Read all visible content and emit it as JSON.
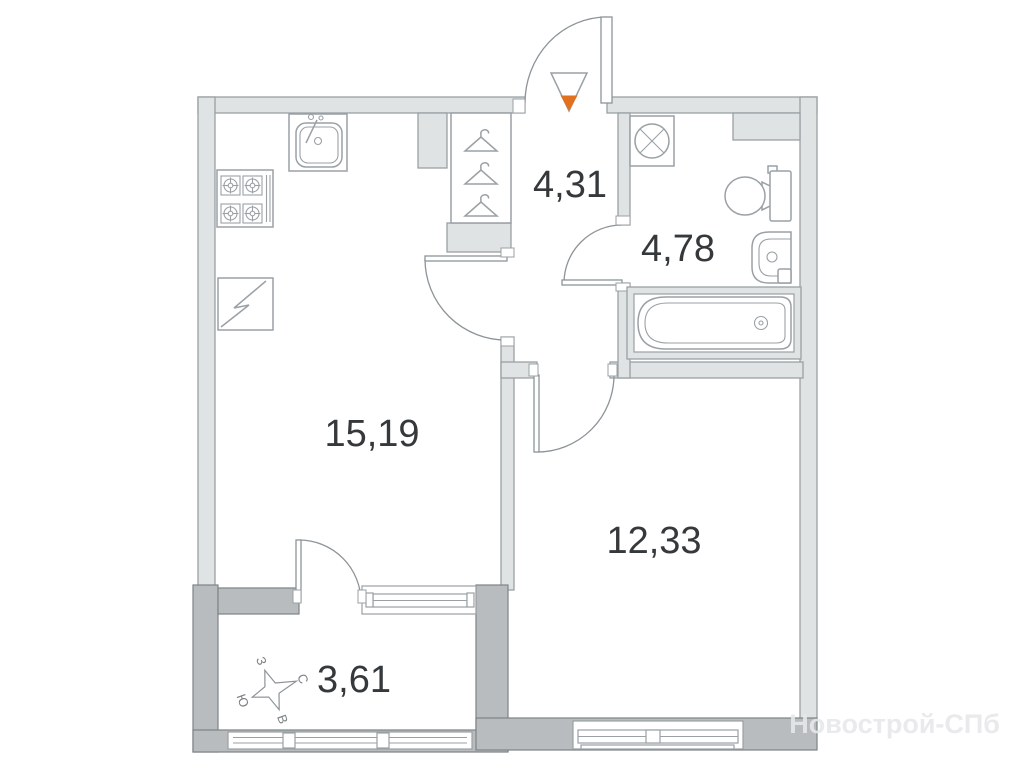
{
  "plan": {
    "rooms": [
      {
        "name": "kitchen-living-room",
        "area": "15,19"
      },
      {
        "name": "hallway",
        "area": "4,31"
      },
      {
        "name": "bathroom",
        "area": "4,78"
      },
      {
        "name": "bedroom",
        "area": "12,33"
      },
      {
        "name": "balcony",
        "area": "3,61"
      }
    ],
    "compass": {
      "north": "С",
      "south": "Ю",
      "west": "З",
      "east": "В"
    },
    "watermark": "Новострой-СПб",
    "colors": {
      "wall_fill": "#e0e3e4",
      "wall_outline": "#9aa1a4",
      "external_wall_fill": "#b9bcbe",
      "fixture_stroke": "#9aa1a5",
      "label_text": "#35393b",
      "entrance_accent": "#e2711f",
      "watermark_text": "#e6e8e9"
    }
  }
}
